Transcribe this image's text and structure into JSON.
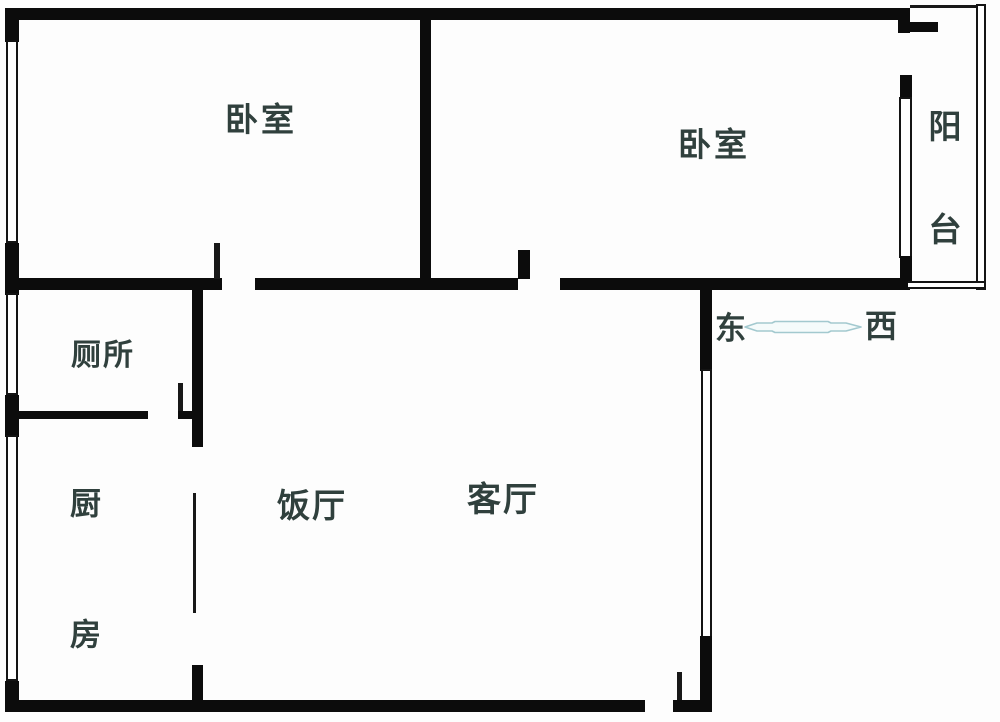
{
  "rooms": {
    "bedroom1": "卧室",
    "bedroom2": "卧室",
    "balcony": "阳台",
    "toilet": "厕所",
    "kitchen": "厨房",
    "dining": "饭厅",
    "living": "客厅"
  },
  "compass": {
    "east": "东",
    "west": "西"
  },
  "colors": {
    "wall": "#0c0c0c",
    "label": "#30403d",
    "arrow_outline": "#a3c9cf",
    "background": "#fdfdfd"
  }
}
